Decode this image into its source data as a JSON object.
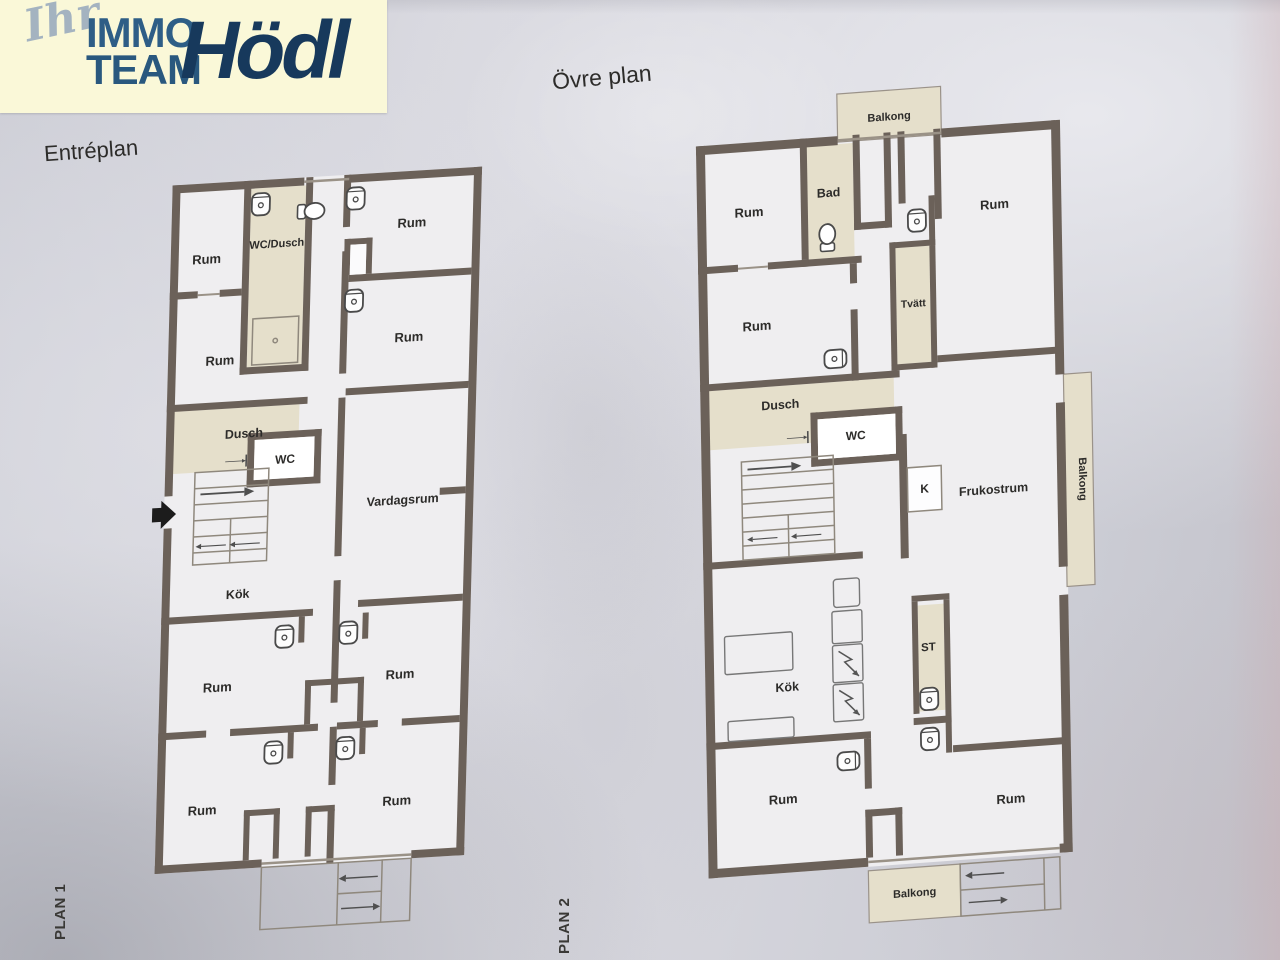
{
  "logo": {
    "script": "Ihr",
    "line1": "IMMO",
    "line2": "TEAM",
    "brand": "Hödl"
  },
  "plans": {
    "plan1": {
      "title": "Entréplan",
      "side_label": "PLAN 1",
      "rooms": {
        "rum_tl": "Rum",
        "wc_dusch": "WC/Dusch",
        "rum_tr": "Rum",
        "rum_ml": "Rum",
        "rum_mr": "Rum",
        "dusch": "Dusch",
        "wc": "WC",
        "vardagsrum": "Vardagsrum",
        "kok": "Kök",
        "rum_3l": "Rum",
        "rum_3r": "Rum",
        "rum_4l": "Rum",
        "rum_4r": "Rum"
      }
    },
    "plan2": {
      "title": "Övre plan",
      "side_label": "PLAN 2",
      "rooms": {
        "balkong_top": "Balkong",
        "rum_tl": "Rum",
        "bad": "Bad",
        "rum_tr": "Rum",
        "rum_ml": "Rum",
        "tvatt": "Tvätt",
        "dusch": "Dusch",
        "wc": "WC",
        "k": "K",
        "frukostrum": "Frukostrum",
        "balkong_right": "Balkong",
        "kok": "Kök",
        "st": "ST",
        "rum_bl": "Rum",
        "rum_br": "Rum",
        "balkong_bottom": "Balkong"
      }
    }
  },
  "colors": {
    "paper": "#d6d6dd",
    "wall": "#6b6159",
    "room_fill": "#efeef0",
    "beige": "#e5dfcb",
    "thin_line": "#8f887d",
    "logo_bg": "#faf8d8",
    "logo_blue": "#2e5e86",
    "logo_navy": "#17395c",
    "logo_script": "#a4b3c0"
  }
}
